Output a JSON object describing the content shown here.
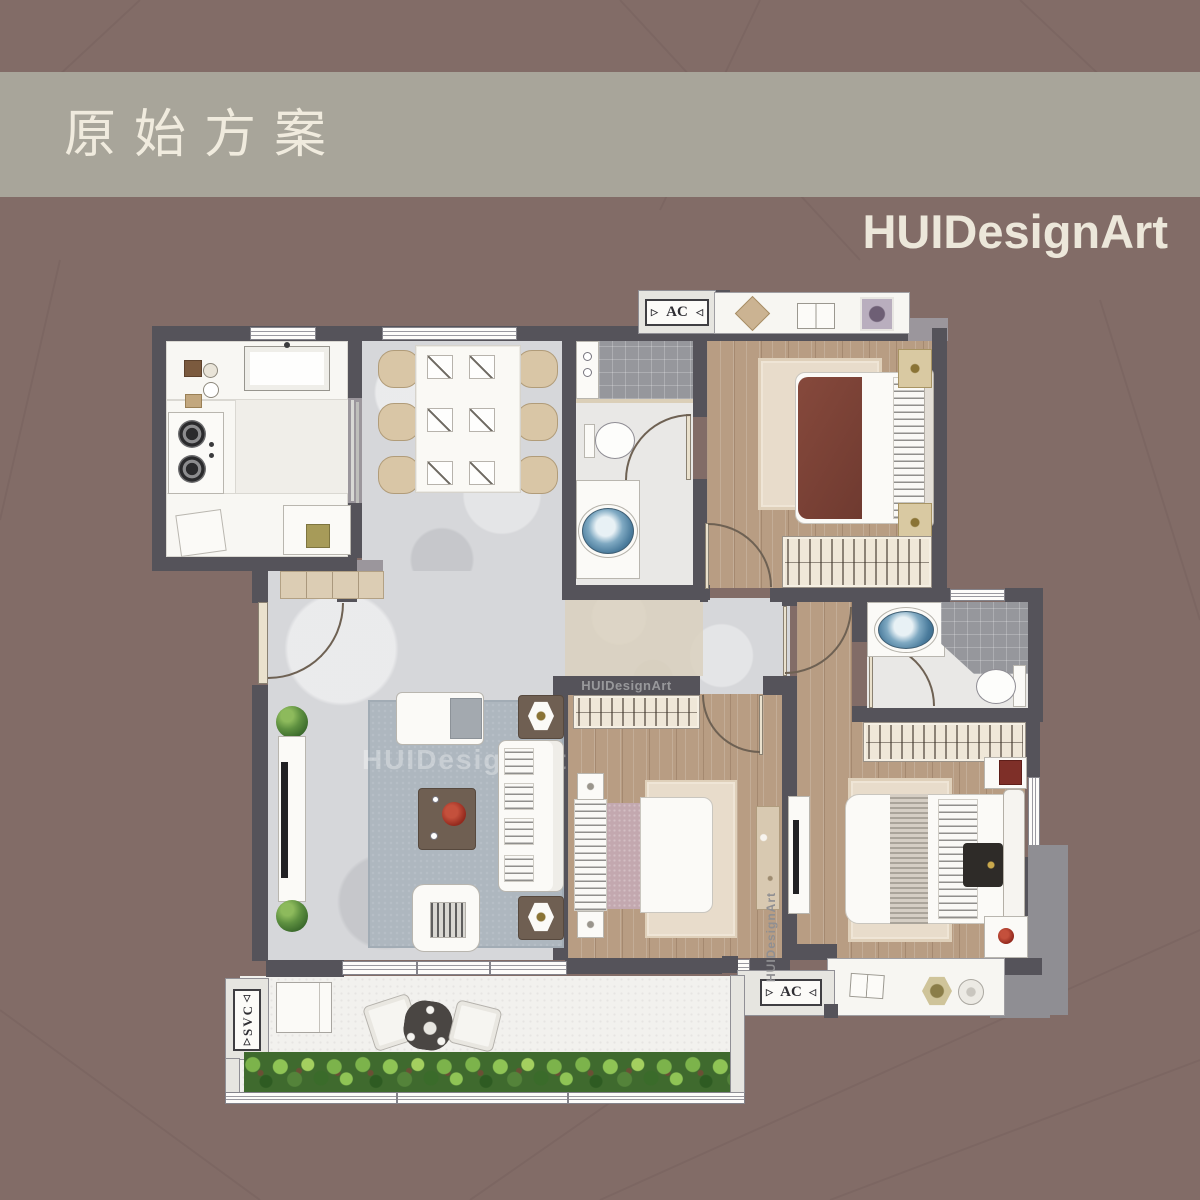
{
  "header": {
    "title": "原始方案"
  },
  "brand": {
    "name": "HUIDesignArt"
  },
  "labels": {
    "ac": "AC",
    "svc": "SVC"
  },
  "icons": {
    "arrow_left": "◁",
    "arrow_right": "▷",
    "arrow_up": "△",
    "arrow_down": "▽"
  },
  "watermarks": {
    "closet_bar": "HUIDesignArt",
    "master_vertical": "HUIDesignArt",
    "living_faint": "HUIDesignArt"
  },
  "colors": {
    "background": "#826C67",
    "header_band": "#A8A59A",
    "header_text": "#F0EBDE",
    "wall_dark": "#55535A",
    "wall_light": "#9B969C",
    "wood_floor": "#B89D83",
    "marble_floor": "#D6D7DA",
    "balcony_floor": "#F2F1EE",
    "rug_blue": "#AEB7BF",
    "rug_beige": "#E8DCCB",
    "bed_red": "#7A4136",
    "bed_pink": "#C3A8AF",
    "plant_green": "#5E9040",
    "sink_blue": "#4A7B9C",
    "accent_red": "#93291D"
  }
}
